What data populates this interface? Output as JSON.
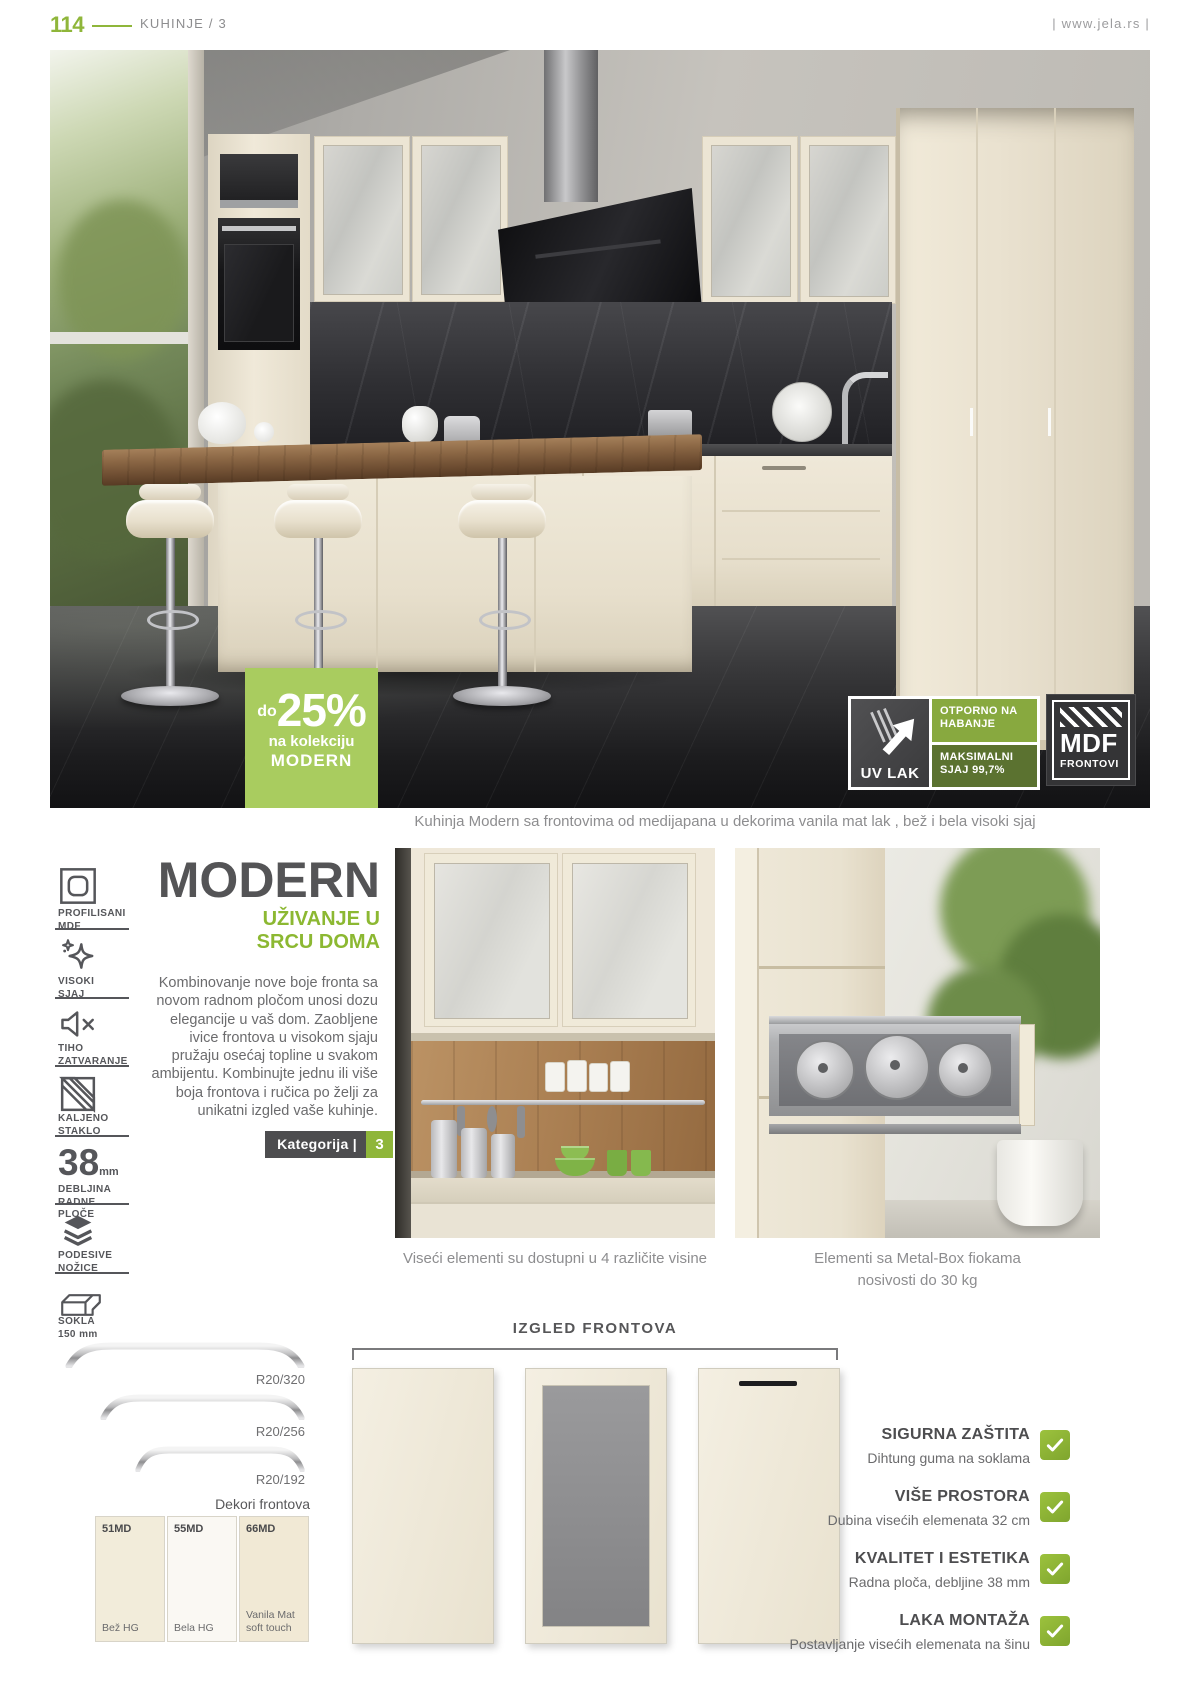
{
  "page": {
    "number": "114",
    "section": "KUHINJE / 3",
    "site": "| www.jela.rs |"
  },
  "hero": {
    "discount": {
      "prefix": "do",
      "value": "25%",
      "line2": "na kolekciju",
      "line3": "MODERN"
    },
    "uv_badge": {
      "name": "UV LAK",
      "claim_top": "OTPORNO NA HABANJE",
      "claim_bottom": "MAKSIMALNI SJAJ 99,7%"
    },
    "mdf_badge": {
      "line1": "MDF",
      "line2": "FRONTOVI"
    },
    "caption": "Kuhinja Modern sa frontovima od medijapana u dekorima vanila mat lak , bež  i bela visoki sjaj"
  },
  "sidebar": {
    "items": [
      {
        "line1": "PROFILISANI",
        "line2": "MDF"
      },
      {
        "line1": "VISOKI",
        "line2": "SJAJ"
      },
      {
        "line1": "TIHO",
        "line2": "ZATVARANJE"
      },
      {
        "line1": "KALJENO",
        "line2": "STAKLO"
      },
      {
        "value": "38",
        "unit": "mm",
        "line1": "DEBLJINA",
        "line2": "RADNE PLOČE"
      },
      {
        "line1": "PODESIVE",
        "line2": "NOŽICE"
      },
      {
        "line1": "SOKLA",
        "line2": "150 mm"
      }
    ]
  },
  "intro": {
    "title": "MODERN",
    "subtitle1": "UŽIVANJE U",
    "subtitle2": "SRCU DOMA",
    "body": "Kombinovanje nove boje fronta sa novom radnom pločom unosi dozu elegancije u vaš dom. Zaobljene ivice frontova u visokom sjaju pružaju osećaj topline u svakom ambijentu. Kombinujte jednu ili više boja frontova i ručica po želji  za unikatni izgled vaše kuhinje.",
    "category_label": "Kategorija |",
    "category_value": "3"
  },
  "gallery": {
    "caption_left": "Viseći elementi su dostupni u 4 različite visine",
    "caption_right_1": "Elementi sa Metal-Box fiokama",
    "caption_right_2": "nosivosti do 30 kg"
  },
  "handles": {
    "items": [
      {
        "label": "R20/320"
      },
      {
        "label": "R20/256"
      },
      {
        "label": "R20/192"
      }
    ]
  },
  "decors": {
    "title": "Dekori frontova",
    "items": [
      {
        "code": "51MD",
        "name1": "Bež HG",
        "name2": "",
        "color": "#f2ecda"
      },
      {
        "code": "55MD",
        "name1": "Bela HG",
        "name2": "",
        "color": "#faf8f3"
      },
      {
        "code": "66MD",
        "name1": "Vanila Mat",
        "name2": "soft touch",
        "color": "#f1e9d5"
      }
    ]
  },
  "fronts": {
    "title": "IZGLED FRONTOVA"
  },
  "benefits": {
    "items": [
      {
        "title": "SIGURNA ZAŠTITA",
        "desc": "Dihtung guma na soklama"
      },
      {
        "title": "VIŠE PROSTORA",
        "desc": "Dubina visećih elemenata 32 cm"
      },
      {
        "title": "KVALITET I ESTETIKA",
        "desc": "Radna ploča, debljine 38 mm"
      },
      {
        "title": "LAKA MONTAŽA",
        "desc": "Postavljanje visećih elemenata na šinu"
      }
    ]
  },
  "colors": {
    "accent": "#8fb63a",
    "badge_green": "#a9cc5f",
    "uv_top": "#88a93f",
    "uv_bottom": "#5b7230",
    "dark": "#4d4d4f"
  }
}
